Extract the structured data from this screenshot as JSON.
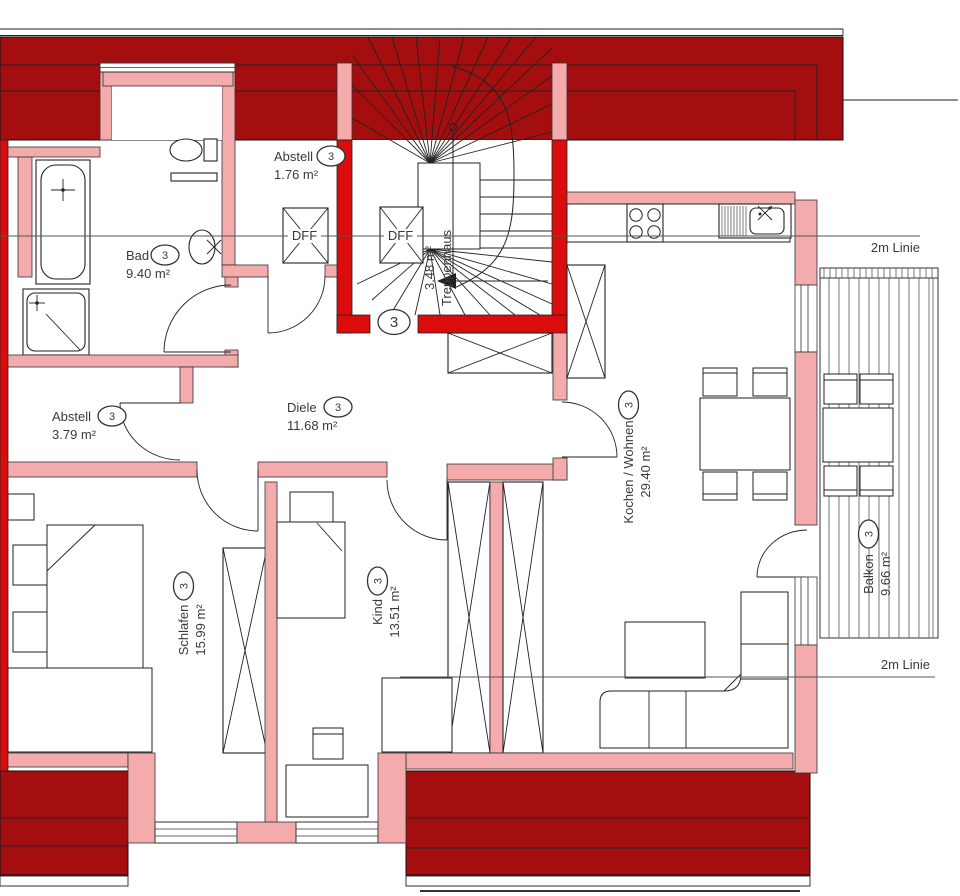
{
  "colors": {
    "roof_dark": "#a50e0e",
    "wall_red": "#da0c0c",
    "wall_pink": "#f4abab"
  },
  "apartment_number": "3",
  "skylight_label": "DFF",
  "guide_lines": {
    "top": "2m Linie",
    "bottom": "2m Linie"
  },
  "rooms": {
    "abstell_klein": {
      "name": "Abstell",
      "area": "1.76 m²"
    },
    "bad": {
      "name": "Bad",
      "area": "9.40 m²"
    },
    "treppenhaus": {
      "name": "Treppenhaus",
      "area": "3.48 m²"
    },
    "abstell_gross": {
      "name": "Abstell",
      "area": "3.79 m²"
    },
    "diele": {
      "name": "Diele",
      "area": "11.68 m²"
    },
    "schlafen": {
      "name": "Schlafen",
      "area": "15.99 m²"
    },
    "kind": {
      "name": "Kind",
      "area": "13.51 m²"
    },
    "kochen_wohnen": {
      "name": "Kochen / Wohnen",
      "area": "29.40 m²"
    },
    "balkon": {
      "name": "Balkon",
      "area": "9.66 m²"
    }
  }
}
